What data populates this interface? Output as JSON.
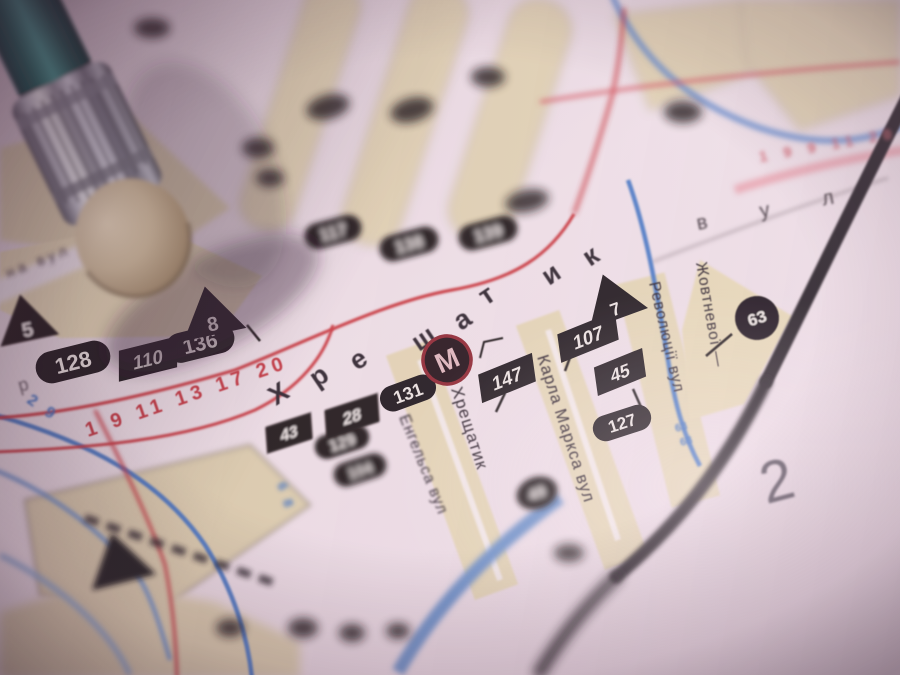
{
  "sheet": {
    "number": "2"
  },
  "metro": {
    "symbol": "М",
    "station": "Хрещатик"
  },
  "streets": {
    "big_letters": [
      "Х",
      "р",
      "е",
      "щ",
      "а",
      "т",
      "и",
      "к"
    ],
    "engelsa": "Енгельса вул",
    "karla_marksa": "Карла Маркса вул",
    "revolutsii": "Революції вул",
    "zhovtnevoi": "Жовтневої —",
    "na_vul": "на вул",
    "vul_spread": "в у л",
    "letter_r": "р"
  },
  "badges": {
    "oval_128": "128",
    "oval_136": "136",
    "oval_131": "131",
    "oval_127": "127",
    "oval_117": "117",
    "oval_138": "138",
    "oval_139": "139",
    "oval_129": "129",
    "oval_104": "104",
    "flag_110": "110",
    "flag_107": "107",
    "flag_147": "147",
    "flag_45": "45",
    "flag_43": "43",
    "flag_28": "28",
    "tri_5": "5",
    "tri_8": "8",
    "tri_7": "7",
    "circle_63": "63",
    "circle_49": "49"
  },
  "routes": {
    "tram_red": "1 9 11 13 17 20",
    "tram_red_top": "1 9 9 11 20",
    "blue_29": "2 9",
    "blue_68": "6 8",
    "blue_63": "63",
    "blue_68b": "68"
  },
  "colors": {
    "paper": "#ecdfe6",
    "block_tan": "#e3d5b4",
    "badge_black": "#1b1519",
    "line_red": "#c9373d",
    "line_blue": "#4a79c4",
    "line_pink": "#e8a8b2",
    "border_black": "#201a20",
    "metro_ring": "#8e2630",
    "pencil_teal": "#2a7a74",
    "ferrule_silver": "#c9c9d3",
    "eraser_beige": "#cfbc99"
  }
}
